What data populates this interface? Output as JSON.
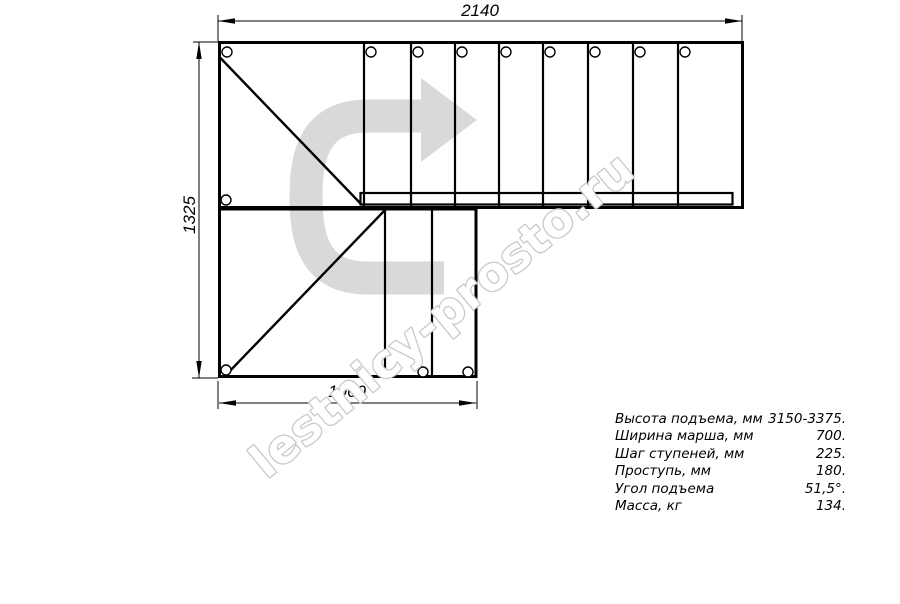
{
  "drawing": {
    "title": "stair-plan-top-view",
    "dim_top": "2140",
    "dim_left": "1325",
    "dim_bottom": "1060"
  },
  "watermark": {
    "text": "lestnicy-prosto.ru"
  },
  "specs": {
    "rows": [
      {
        "label": "Высота подъема, мм",
        "value": "3150-3375."
      },
      {
        "label": "Ширина марша, мм",
        "value": "700."
      },
      {
        "label": "Шаг ступеней, мм",
        "value": "225."
      },
      {
        "label": "Проступь, мм",
        "value": "180."
      },
      {
        "label": "Угол подъема",
        "value": "51,5°."
      },
      {
        "label": "Масса, кг",
        "value": "134."
      }
    ]
  },
  "colors": {
    "line": "#000000",
    "direction_arrow": "#d9d9d9",
    "watermark_stroke": "#c9c9c9",
    "watermark_fill": "#ffffff"
  }
}
